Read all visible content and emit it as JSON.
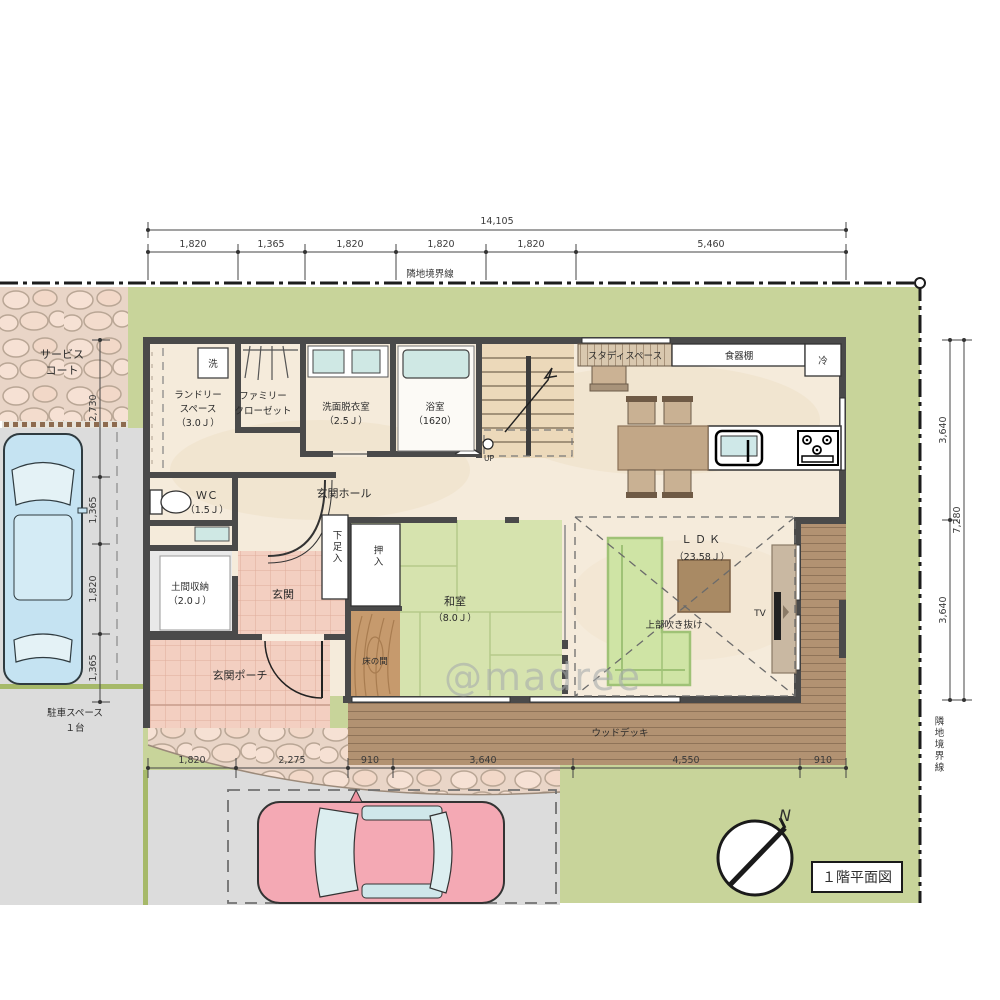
{
  "meta": {
    "title": "１階平面図",
    "north": "N",
    "watermark": "@madree",
    "up": "UP",
    "tv": "TV"
  },
  "boundary": {
    "top_label": "隣地境界線",
    "right_label": "隣地境界線"
  },
  "dims": {
    "top_total": "14,105",
    "top": [
      "1,820",
      "1,365",
      "1,820",
      "1,820",
      "1,820",
      "5,460"
    ],
    "left": [
      "2,730",
      "1,365",
      "1,820",
      "1,365"
    ],
    "right": [
      "3,640",
      "3,640"
    ],
    "right_total": "7,280",
    "bottom": [
      "1,820",
      "2,275",
      "910",
      "3,640",
      "4,550",
      "910"
    ]
  },
  "rooms": {
    "service_court_1": "サービス",
    "service_court_2": "コート",
    "laundry_1": "ランドリー",
    "laundry_2": "スペース",
    "laundry_3": "（3.0Ｊ）",
    "closet_1": "ファミリー",
    "closet_2": "クローゼット",
    "washroom_1": "洗面脱衣室",
    "washroom_2": "（2.5Ｊ）",
    "bath_1": "浴室",
    "bath_2": "（1620）",
    "wc_1": "ＷＣ",
    "wc_2": "（1.5Ｊ）",
    "doma_1": "土間収納",
    "doma_2": "（2.0Ｊ）",
    "genkan": "玄関",
    "hall": "玄関ホール",
    "porch": "玄関ポーチ",
    "shoes": "下足入",
    "oshiire": "押入",
    "washitsu_1": "和室",
    "washitsu_2": "（8.0Ｊ）",
    "tokonoma": "床の間",
    "ldk_1": "ＬＤＫ",
    "ldk_2": "（23.58Ｊ）",
    "void_above": "上部吹き抜け",
    "deck": "ウッドデッキ",
    "study": "スタディスペース",
    "cupboard": "食器棚",
    "fridge": "冷",
    "washer": "洗",
    "parking_1": "駐車スペース",
    "parking_2": "１台"
  },
  "colors": {
    "lawn": "#c8d49a",
    "floor": "#f5ebdb",
    "tatami": "#d6e3ae",
    "deck": "#b29272",
    "tile": "#f3cfc1",
    "wall": "#4a4a4a",
    "drive": "#dcdcdc",
    "car_blue": "#c5e3f2",
    "car_pink": "#f4a9b4",
    "sofa": "#cfe4a5"
  }
}
